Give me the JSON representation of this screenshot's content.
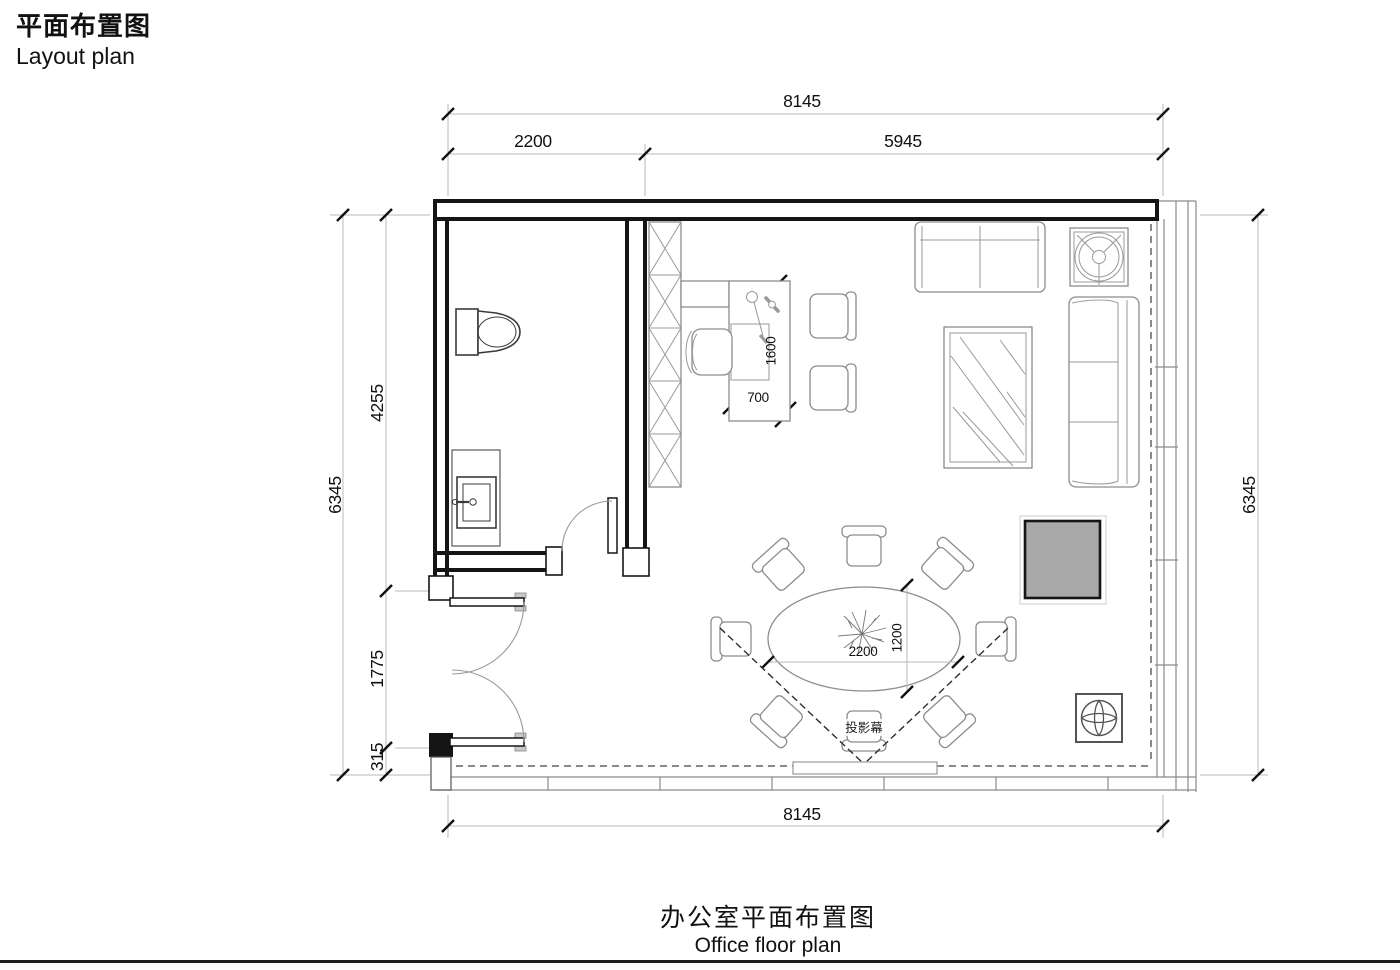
{
  "header": {
    "title_zh": "平面布置图",
    "title_en": "Layout plan"
  },
  "footer": {
    "caption_zh": "办公室平面布置图",
    "caption_en": "Office floor plan"
  },
  "dimensions": {
    "top_total": "8145",
    "top_left": "2200",
    "top_right": "5945",
    "left_total": "6345",
    "left_upper": "4255",
    "left_mid": "1775",
    "left_lower": "315",
    "right_total": "6345",
    "bottom_total": "8145",
    "desk_length": "1600",
    "desk_depth": "700",
    "table_length": "2200",
    "table_width": "1200"
  },
  "labels": {
    "projection_screen": "投影幕"
  },
  "colors": {
    "wall": "#151515",
    "furniture_line": "#8c8c8c",
    "dimension_line": "#b8b8b8",
    "text": "#111111",
    "av_cabinet_fill": "#a8a8a8"
  }
}
